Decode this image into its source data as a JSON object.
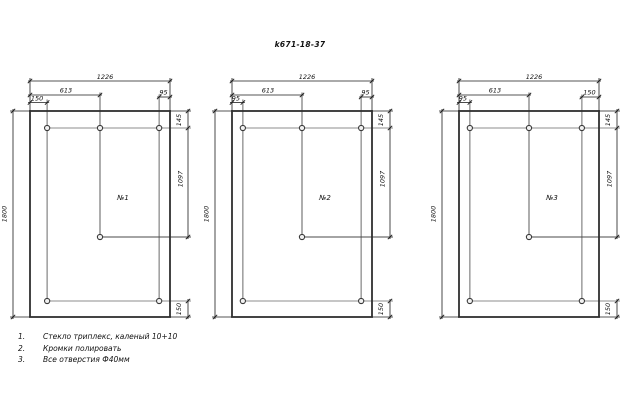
{
  "title": "k671-18-37",
  "notes": [
    {
      "num": "1.",
      "text": "Стекло триплекс, каленый 10+10"
    },
    {
      "num": "2.",
      "text": "Кромки полировать"
    },
    {
      "num": "3.",
      "text": "Все отверстия Ф40мм"
    }
  ],
  "drawing": {
    "canvas": {
      "width": 641,
      "height": 410
    },
    "colors": {
      "background": "#ffffff",
      "outline": "#2f2f2f",
      "dim": "#1c1c1c",
      "aux": "#8c8c8c",
      "center": "#4a4a4a",
      "text": "#111111"
    },
    "panel_width_mm": 1226,
    "panel_height_mm": 1800,
    "panels": [
      {
        "label": "№1",
        "x": 30,
        "dims": {
          "overall_width": "1226",
          "center_hole": "613",
          "left_hole": "150",
          "right_hole": "95",
          "overall_height": "1800",
          "top_offset": "145",
          "middle_offset": "1097",
          "bottom_offset": "150"
        }
      },
      {
        "label": "№2",
        "x": 232,
        "dims": {
          "overall_width": "1226",
          "center_hole": "613",
          "left_hole": "95",
          "right_hole": "95",
          "overall_height": "1800",
          "top_offset": "145",
          "middle_offset": "1097",
          "bottom_offset": "150"
        }
      },
      {
        "label": "№3",
        "x": 459,
        "dims": {
          "overall_width": "1226",
          "center_hole": "613",
          "left_hole": "95",
          "right_hole": "150",
          "overall_height": "1800",
          "top_offset": "145",
          "middle_offset": "1097",
          "bottom_offset": "150"
        }
      }
    ]
  }
}
